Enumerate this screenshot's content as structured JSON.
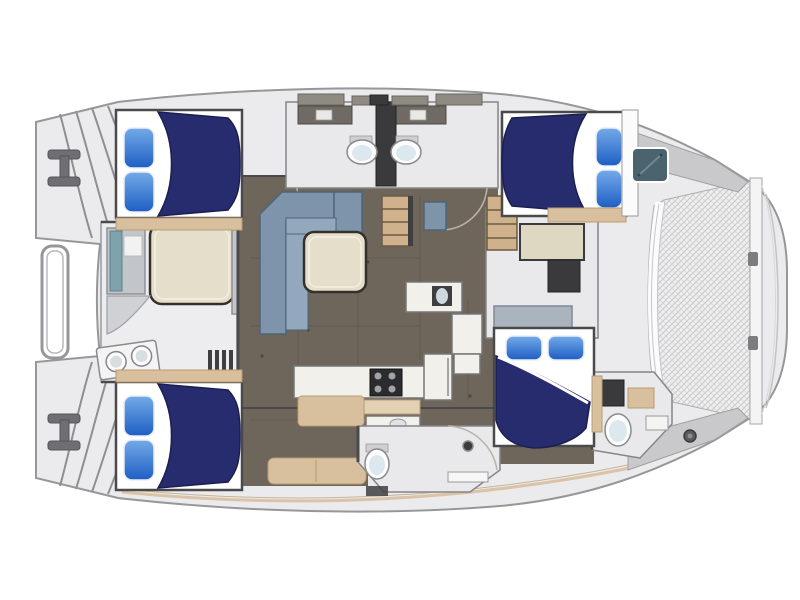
{
  "figure": {
    "aria_label": "Catamaran yacht interior floor plan, top-down view, bow at right with trampoline netting, stern transom steps at left"
  },
  "colors": {
    "page_bg": "#ffffff",
    "hull": "#ebebed",
    "hull_stroke": "#97979a",
    "wall_dark": "#4a4a4c",
    "floor_brown": "#6e665b",
    "floor_seam": "#57504a",
    "bed_navy": "#272c6e",
    "bed_navy_edge": "#1b1f50",
    "pillow_hi": "#74aae8",
    "pillow_lo": "#1e5ec4",
    "sheet_white": "#ffffff",
    "sofa_back": "#7e94ab",
    "sofa_seat": "#93a8bc",
    "sofa_stroke": "#4f6478",
    "cushion_teal": "#7fa3ad",
    "table_cream": "#e4decb",
    "table_stroke": "#35312a",
    "wood_tan": "#d8bf9e",
    "wood_tan_dark": "#b99c72",
    "wood_step": "#cfb28c",
    "counter_white": "#f1f0ea",
    "counter_stroke": "#77777a",
    "room_gray": "#e9e9eb",
    "room_stroke": "#85858a",
    "bench_gray": "#c2c6ca",
    "bench_stroke": "#8d9195",
    "stove_dark": "#2c2c2e",
    "window_teal": "#4b636e",
    "mesh_bg": "#efefef",
    "mesh_line": "#c8c8ca",
    "deck_shade": "#c9c9cb",
    "fixture_white": "#fdfdfd",
    "fixture_inner": "#dce8ee",
    "cabinet_taupe": "#6f6b64",
    "locker_taupe": "#8f8a82",
    "metal_gray": "#6f6f73"
  },
  "features": {
    "double_beds": 4,
    "pillows_per_bed": 2,
    "toilets": 4,
    "galley_sinks": 1,
    "cockpit_sinks": 2,
    "stove_burners": 4,
    "salon_sofa": "L-shaped",
    "salon_tables": 1,
    "cockpit_tables": 1,
    "trampoline_nets": 1,
    "transom_step_platforms": 2,
    "cabin_windows": 1,
    "shower_rooms": 2
  }
}
